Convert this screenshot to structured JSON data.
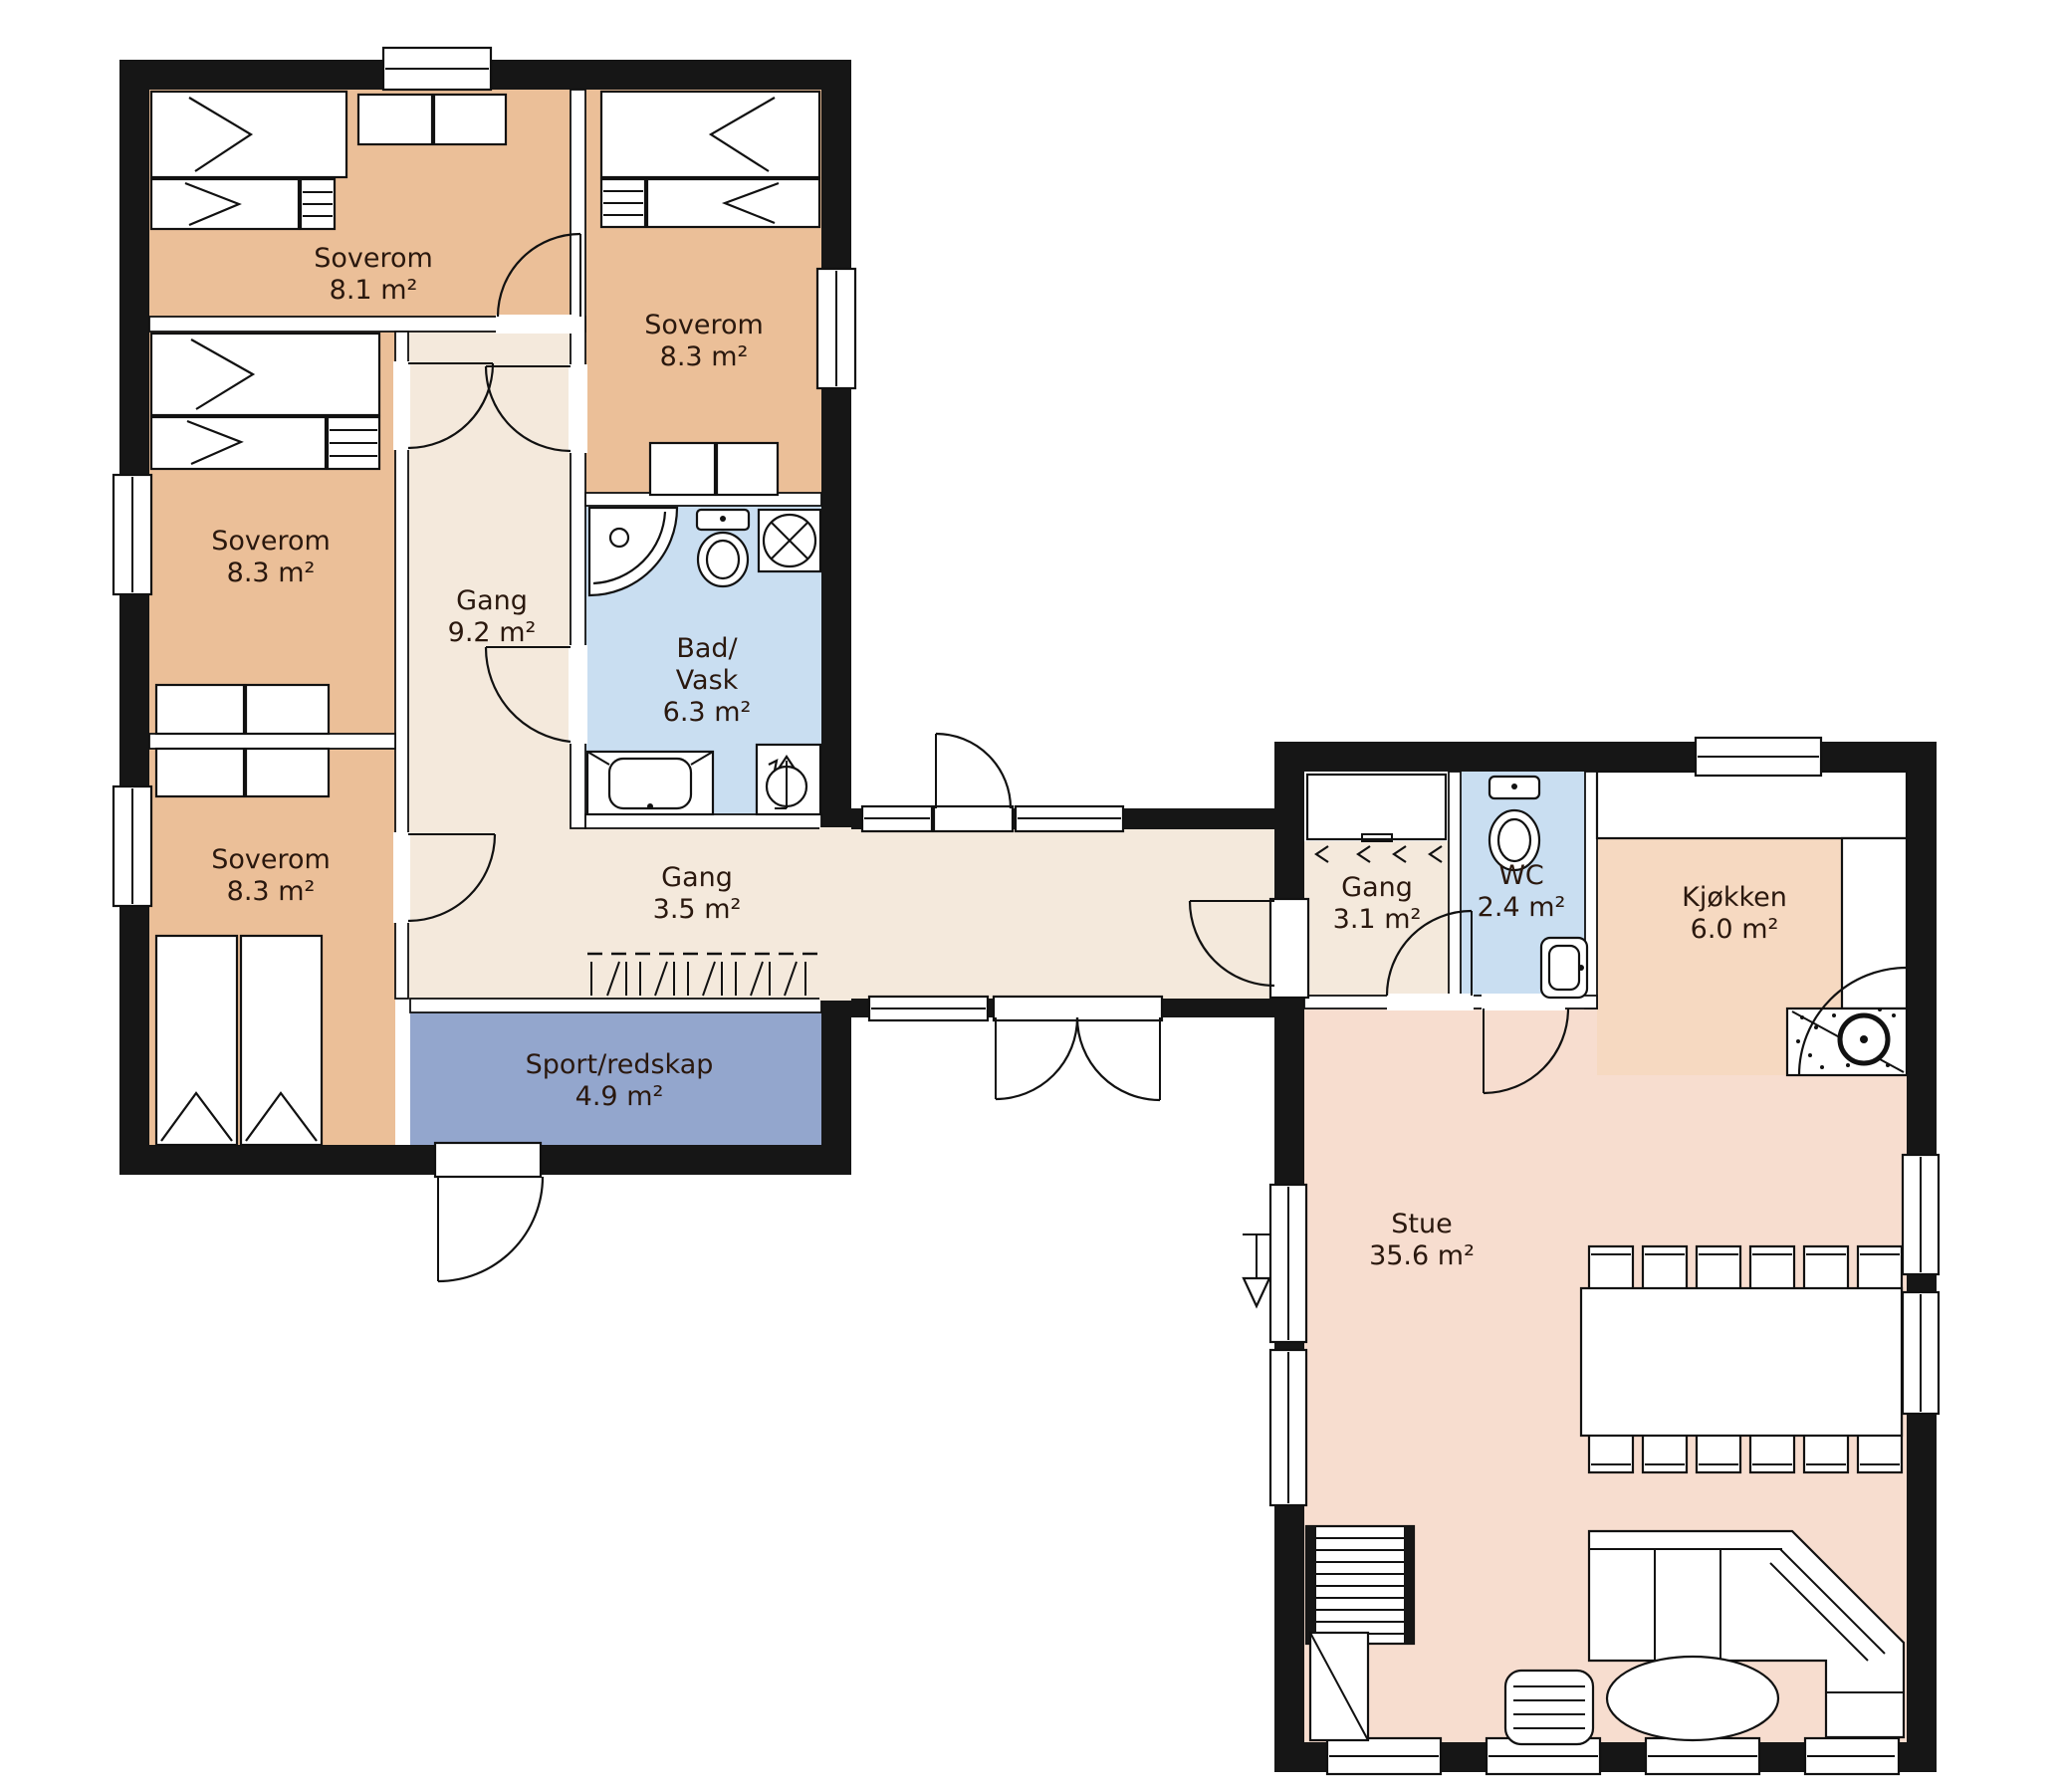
{
  "floorplan": {
    "type": "cabin-floor-plan",
    "language": "Norwegian",
    "unit": "m²",
    "rooms": [
      {
        "id": "soverom-top-left",
        "name": "Soverom",
        "area": "8.1 m²"
      },
      {
        "id": "soverom-top-right",
        "name": "Soverom",
        "area": "8.3 m²"
      },
      {
        "id": "soverom-mid-left",
        "name": "Soverom",
        "area": "8.3 m²"
      },
      {
        "id": "soverom-bottom-left",
        "name": "Soverom",
        "area": "8.3 m²"
      },
      {
        "id": "gang-corridor",
        "name": "Gang",
        "area": "9.2 m²"
      },
      {
        "id": "bad-vask",
        "name_line1": "Bad/",
        "name_line2": "Vask",
        "area": "6.3 m²"
      },
      {
        "id": "gang-small",
        "name": "Gang",
        "area": "3.5 m²"
      },
      {
        "id": "sport-redskap",
        "name": "Sport/redskap",
        "area": "4.9 m²"
      },
      {
        "id": "gang-entry",
        "name": "Gang",
        "area": "3.1 m²"
      },
      {
        "id": "wc",
        "name": "WC",
        "area": "2.4 m²"
      },
      {
        "id": "kjokken",
        "name": "Kjøkken",
        "area": "6.0 m²"
      },
      {
        "id": "stue",
        "name": "Stue",
        "area": "35.6 m²"
      }
    ],
    "colors": {
      "bedroom": "#ebbf98",
      "corridor": "#f4e9dc",
      "bathroom": "#c9def1",
      "storage": "#93a6cd",
      "kitchen": "#f6d9c1",
      "living": "#f7ddcf",
      "wall": "#161616",
      "outline": "#111111",
      "label_text": "#2a180e"
    },
    "furniture": [
      "bunk-bed",
      "bunk-bed",
      "bunk-bed",
      "single-bed",
      "single-bed",
      "wardrobe",
      "wardrobe",
      "wardrobe",
      "wardrobe",
      "shower",
      "toilet",
      "washing-machine",
      "vanity-sink",
      "water-heater",
      "coat-rack",
      "entry-wardrobe",
      "toilet",
      "hand-basin",
      "kitchen-counter",
      "fireplace-stove",
      "dining-table",
      "dining-chairs-x12",
      "corner-sofa",
      "coffee-table",
      "armchair",
      "stairs",
      "cabinet"
    ]
  }
}
